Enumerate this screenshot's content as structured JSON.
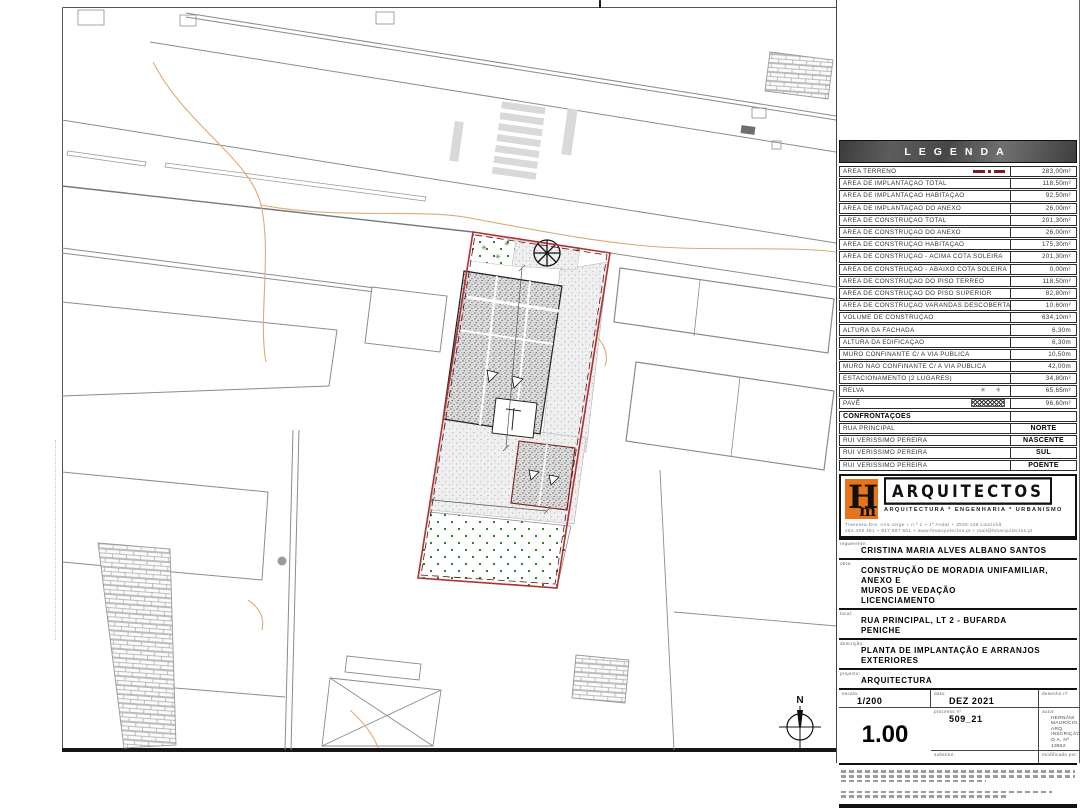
{
  "legend": {
    "title": "LEGENDA",
    "rows": [
      {
        "label": "ÁREA TERRENO",
        "value": "283,00m²",
        "symbol": "terreno"
      },
      {
        "label": "ÁREA DE IMPLANTAÇÃO TOTAL",
        "value": "118,50m²"
      },
      {
        "label": "ÁREA DE IMPLANTAÇÃO HABITAÇÃO",
        "value": "92,50m²"
      },
      {
        "label": "ÁREA DE IMPLANTAÇÃO DO ANEXO",
        "value": "26,00m²"
      },
      {
        "label": "ÁREA DE CONSTRUÇÃO TOTAL",
        "value": "201,30m²"
      },
      {
        "label": "ÁREA DE CONSTRUÇÃO DO ANEXO",
        "value": "26,00m²"
      },
      {
        "label": "ÁREA DE CONSTRUÇÃO HABITAÇÃO",
        "value": "175,30m²"
      },
      {
        "label": "ÁREA DE CONSTRUÇÃO - ACIMA COTA SOLEIRA",
        "value": "201,30m²"
      },
      {
        "label": "ÁREA DE CONSTRUÇÃO - ABAIXO COTA SOLEIRA",
        "value": "0,00m²"
      },
      {
        "label": "ÁREA DE CONSTRUÇÃO DO PISO TÉRREO",
        "value": "118,50m²"
      },
      {
        "label": "ÁREA DE CONSTRUÇÃO DO PISO SUPERIOR",
        "value": "82,80m²"
      },
      {
        "label": "ÁREA DE CONSTRUÇÃO VARANDAS DESCOBERTAS",
        "value": "10,60m²"
      },
      {
        "label": "VOLUME DE CONSTRUÇÃO",
        "value": "634,10m³"
      },
      {
        "label": "ALTURA DA FACHADA",
        "value": "6,30m"
      },
      {
        "label": "ALTURA DA EDIFICAÇÃO",
        "value": "6,30m"
      },
      {
        "label": "MURO CONFINANTE C/ A VIA PÚBLICA",
        "value": "10,50m"
      },
      {
        "label": "MURO NÃO CONFINANTE C/ A VIA PÚBLICA",
        "value": "42,00m"
      },
      {
        "label": "ESTACIONAMENTO (2 LUGARES)",
        "value": "34,80m²"
      },
      {
        "label": "RELVA",
        "value": "65,65m²",
        "symbol": "relva"
      },
      {
        "label": "PAVÊ",
        "value": "96,60m²",
        "symbol": "pave"
      }
    ]
  },
  "confrontacoes": {
    "title": "CONFRONTAÇÕES",
    "rows": [
      {
        "label": "RUA PRINCIPAL",
        "value": "NORTE"
      },
      {
        "label": "RUI VERISSIMO PEREIRA",
        "value": "NASCENTE"
      },
      {
        "label": "RUI VERISSIMO PEREIRA",
        "value": "SUL"
      },
      {
        "label": "RUI VERISSIMO PEREIRA",
        "value": "POENTE"
      }
    ]
  },
  "firm": {
    "monogram_h": "H",
    "monogram_m": "m",
    "name": "ARQUITECTOS",
    "tagline": "ARQUITECTURA * ENGENHARIA * URBANISMO",
    "address_lines": [
      "Travessa Dra. Ana Jorge + n.º 1 + 1º Andar + 2530-138 Lourinhã",
      "261 459 481 + 917 967 661 + www.hmarquitectos.pt + mail@hmarquitectos.pt"
    ],
    "logo_color": "#e8731a"
  },
  "titleblock": {
    "requerente_label": "requerente:",
    "requerente": "CRISTINA MARIA ALVES ALBANO SANTOS",
    "obra_label": "obra:",
    "obra_lines": [
      "CONSTRUÇÃO DE MORADIA UNIFAMILIAR, ANEXO E",
      "MUROS DE VEDAÇÃO",
      "LICENCIAMENTO"
    ],
    "local_label": "local:",
    "local_lines": [
      "RUA PRINCIPAL, LT 2 - BUFARDA",
      "PENICHE"
    ],
    "descricao_label": "descrição:",
    "descricao": "PLANTA DE IMPLANTAÇÃO E ARRANJOS EXTERIORES",
    "projecto_label": "projecto:",
    "projecto": "ARQUITECTURA",
    "escala_label": "escala:",
    "escala": "1/200",
    "data_label": "data:",
    "data": "DEZ 2021",
    "desenho_label": "desenho nº",
    "desenho": "1.00",
    "processo_label": "processo nº",
    "processo": "509_21",
    "autor_label": "autor:",
    "autor_lines": [
      "HERNÂNI MAURÍCIO, ARQ.",
      "INSCRIÇÃO O.A. Nº 13862"
    ],
    "substitui_label": "substitui:",
    "modificado_label": "modificado por:"
  },
  "plan": {
    "north_label": "N",
    "plot_boundary_color": "#b03030",
    "contour_color": "#ddab72",
    "lawn_dot_color": "#2e7d32"
  }
}
